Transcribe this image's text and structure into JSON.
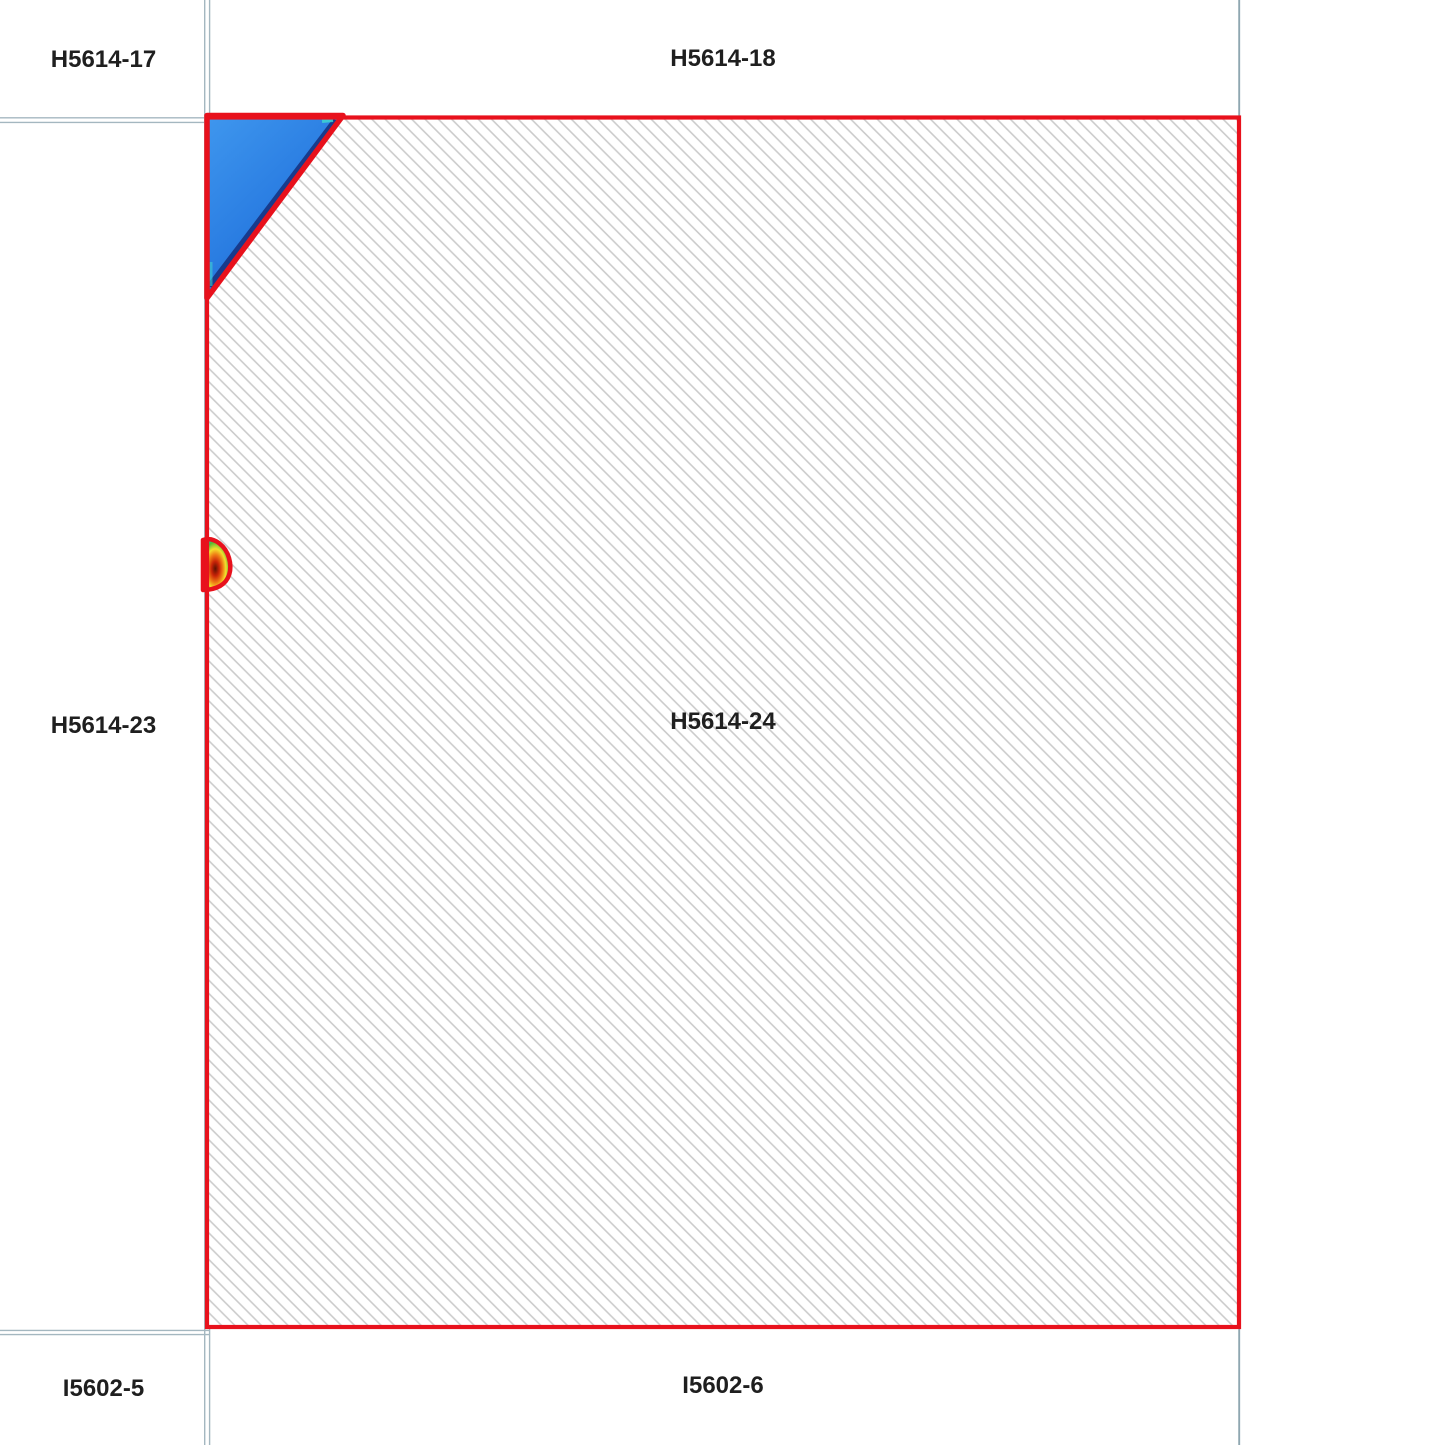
{
  "tiles": {
    "top_left": {
      "label": "H5614-17"
    },
    "top_center": {
      "label": "H5614-18"
    },
    "mid_left": {
      "label": "H5614-23"
    },
    "selected": {
      "label": "H5614-24"
    },
    "bottom_left": {
      "label": "I5602-5"
    },
    "bottom_center": {
      "label": "I5602-6"
    }
  },
  "colors": {
    "background": "#ffffff",
    "grid_line": "#a4b7c0",
    "grid_line_right": "#8fa7b1",
    "selection_border": "#e8111c",
    "hatch_line": "#cbcbcb",
    "tile_fill": "#ffffff",
    "label_text": "#1f1f1f",
    "triangle_blue_top": "#3f97ee",
    "triangle_blue_mid": "#2a7de2",
    "triangle_blue_deep": "#1a5dc8",
    "triangle_dark_edge": "#152f7d",
    "triangle_accent_cyan": "#3fd9d0",
    "blob_center_dark": "#5a1202",
    "blob_red": "#c92408",
    "blob_orange": "#ef7a15",
    "blob_yellow": "#f4e02c",
    "blob_green": "#54bb33",
    "blob_cyan": "#29a9de",
    "blob_blue": "#2744cf"
  }
}
